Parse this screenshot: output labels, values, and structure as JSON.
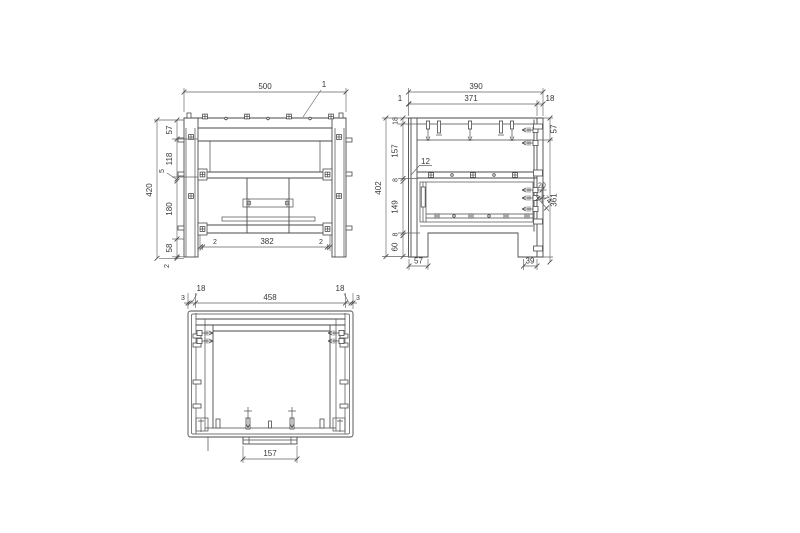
{
  "colors": {
    "background": "#ffffff",
    "line": "#4a4a4a",
    "dim_text": "#383838"
  },
  "front_view": {
    "overall_width": "500",
    "part_leader": "1",
    "height_chain": [
      "57",
      "118",
      "5",
      "180",
      "58",
      "2"
    ],
    "overall_height": "420",
    "bottom_chain": [
      "2",
      "382",
      "2"
    ]
  },
  "side_view": {
    "overall_width": "390",
    "inner_width": "371",
    "back_panel_thickness": "18",
    "front_edge": "1",
    "part_leader": "12",
    "height_chain": [
      "18",
      "157",
      "8",
      "149",
      "8",
      "60"
    ],
    "overall_height": "402",
    "right_chain": [
      "57",
      "361"
    ],
    "foot_front_depth": "57",
    "foot_back_depth": "39",
    "bolt_spacing": "20",
    "diagonal_dim": "74"
  },
  "top_view": {
    "width_chain": [
      "3",
      "18",
      "458",
      "18",
      "3"
    ],
    "bracket_width": "157"
  }
}
